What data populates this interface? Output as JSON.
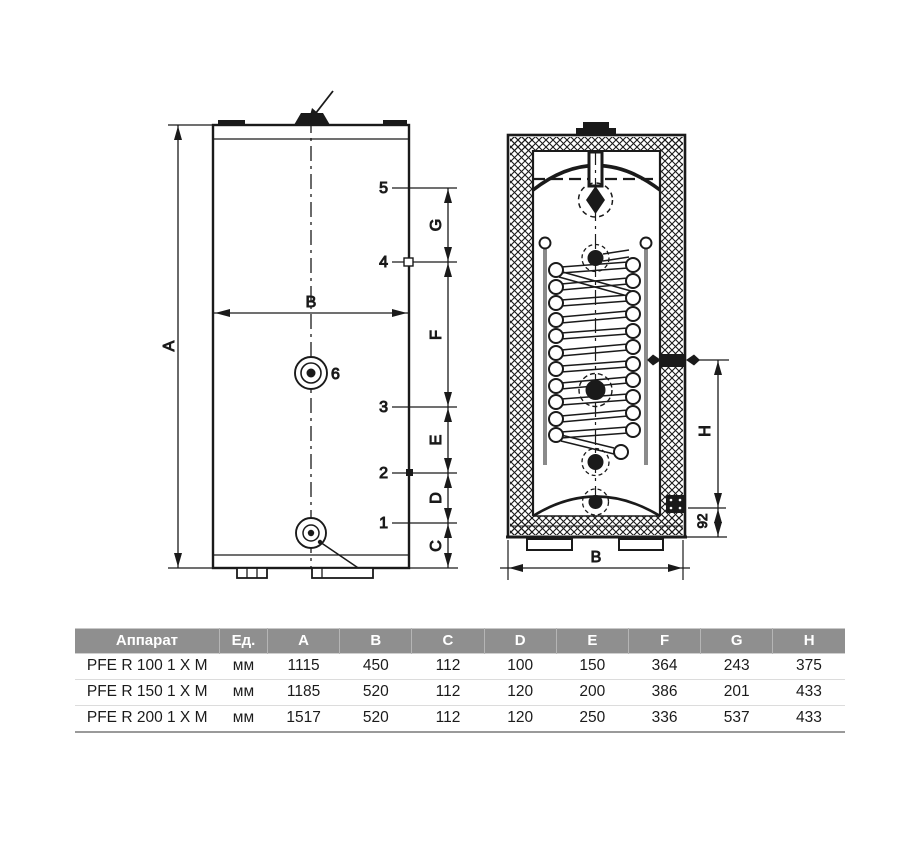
{
  "drawing": {
    "left": {
      "dim_a": "A",
      "dim_b": "B",
      "dim_c": "C",
      "dim_d": "D",
      "dim_e": "E",
      "dim_f": "F",
      "dim_g": "G",
      "port_1": "1",
      "port_2": "2",
      "port_3": "3",
      "port_4": "4",
      "port_5": "5",
      "port_6": "6"
    },
    "right": {
      "dim_h": "H",
      "dim_b": "B",
      "dim_92": "92"
    }
  },
  "table": {
    "headers": [
      "Аппарат",
      "Ед.",
      "A",
      "B",
      "C",
      "D",
      "E",
      "F",
      "G",
      "H"
    ],
    "rows": [
      {
        "model": "PFE R 100 1 X M",
        "unit": "мм",
        "values": [
          "1115",
          "450",
          "112",
          "100",
          "150",
          "364",
          "243",
          "375"
        ]
      },
      {
        "model": "PFE R 150 1 X M",
        "unit": "мм",
        "values": [
          "1185",
          "520",
          "112",
          "120",
          "200",
          "386",
          "201",
          "433"
        ]
      },
      {
        "model": "PFE R 200 1 X M",
        "unit": "мм",
        "values": [
          "1517",
          "520",
          "112",
          "120",
          "250",
          "336",
          "537",
          "433"
        ]
      }
    ]
  },
  "colors": {
    "line": "#1a1a1a",
    "table_header_bg": "#8f8f8f",
    "table_header_text": "#ffffff",
    "table_bottom_border": "#9a9a9a"
  }
}
